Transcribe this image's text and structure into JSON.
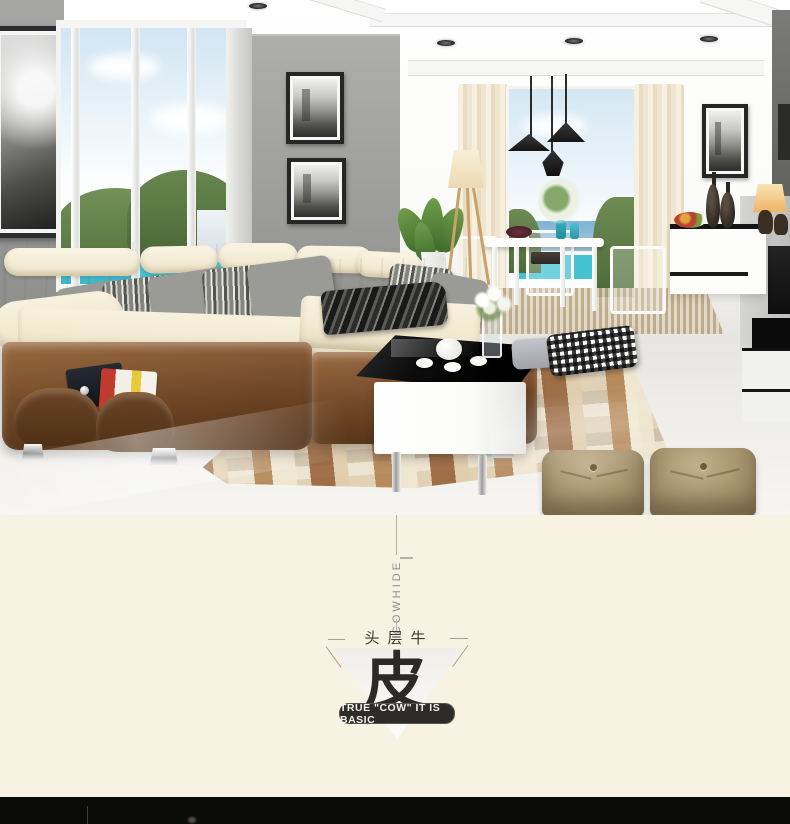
{
  "promo": {
    "vertical_label": "COWHIDE",
    "headline_small": "头层牛",
    "headline_large": "皮",
    "badge_text": "TRUE \"COW\" IT IS BASIC",
    "colors": {
      "background": "#f8f2e3",
      "badge_bg": "#2d2c28",
      "badge_border": "#55544e",
      "badge_text_color": "#f3f2ee",
      "line_color": "#b6b1a6",
      "vertical_label_color": "#8e8d87",
      "headline_color": "#3a3934",
      "triangle_start": "#efeeea",
      "triangle_end": "#fcfbf8",
      "triangle_edge": "#a39f97"
    }
  },
  "scene_colors": {
    "wall_grey": "#9d9d9b",
    "sofa_cream": "#f3ecd6",
    "sofa_brown": "#74492a",
    "floor_light": "#efedea",
    "rug_brown": "#a8744a",
    "rug_tan": "#d9c8ab",
    "ottoman_tan": "#a99272",
    "pendant_black": "#222222",
    "sky_blue": "#cfe5f2",
    "hill_green": "#66854d",
    "pool_cyan": "#46c6d6",
    "sea_blue": "#5e9cc4",
    "bottom_bar": "#0a0a09"
  }
}
